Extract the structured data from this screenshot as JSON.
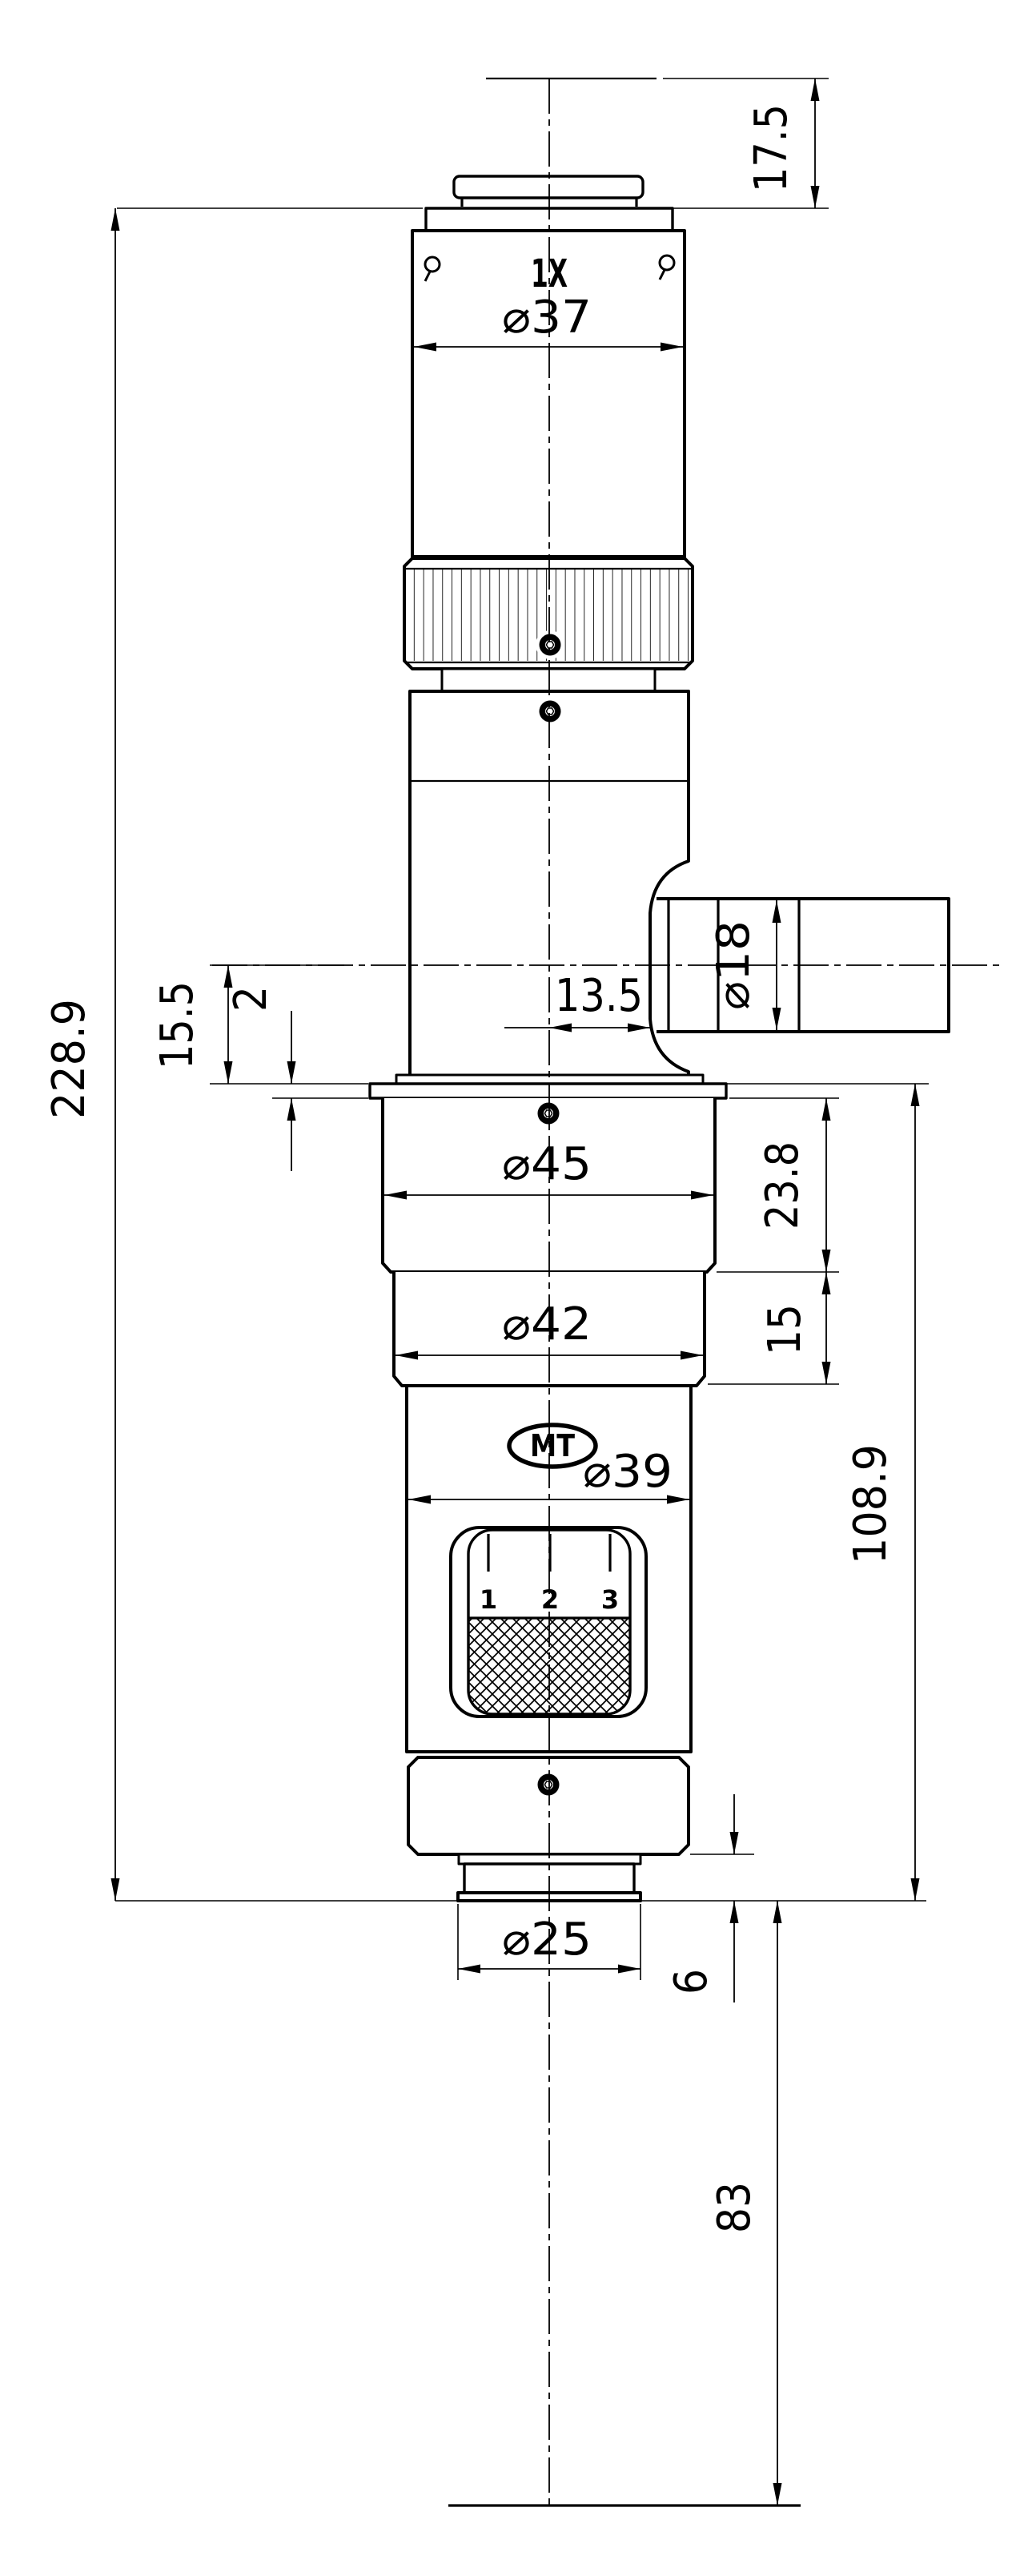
{
  "drawing": {
    "colors": {
      "background": "#ffffff",
      "line": "#000000"
    },
    "labels": {
      "magnification": "1X",
      "logo": "MT"
    },
    "zoom_scale_ticks": [
      "1",
      "2",
      "3"
    ],
    "dimensions": {
      "top_clearance": "17.5",
      "upper_barrel_diameter": "⌀37",
      "side_port_diameter": "⌀18",
      "port_face_offset": "13.5",
      "port_axis_to_flange": "15.5",
      "flange_lip_thickness": "2",
      "mount_ring_diameter": "⌀45",
      "mount_ring_height": "23.8",
      "lower_ring_diameter": "⌀42",
      "lower_ring_height": "15",
      "zoom_body_diameter": "⌀39",
      "flange_to_tip": "108.9",
      "overall_length": "228.9",
      "objective_tip_diameter": "⌀25",
      "tip_protrusion": "6",
      "working_distance": "83"
    }
  }
}
